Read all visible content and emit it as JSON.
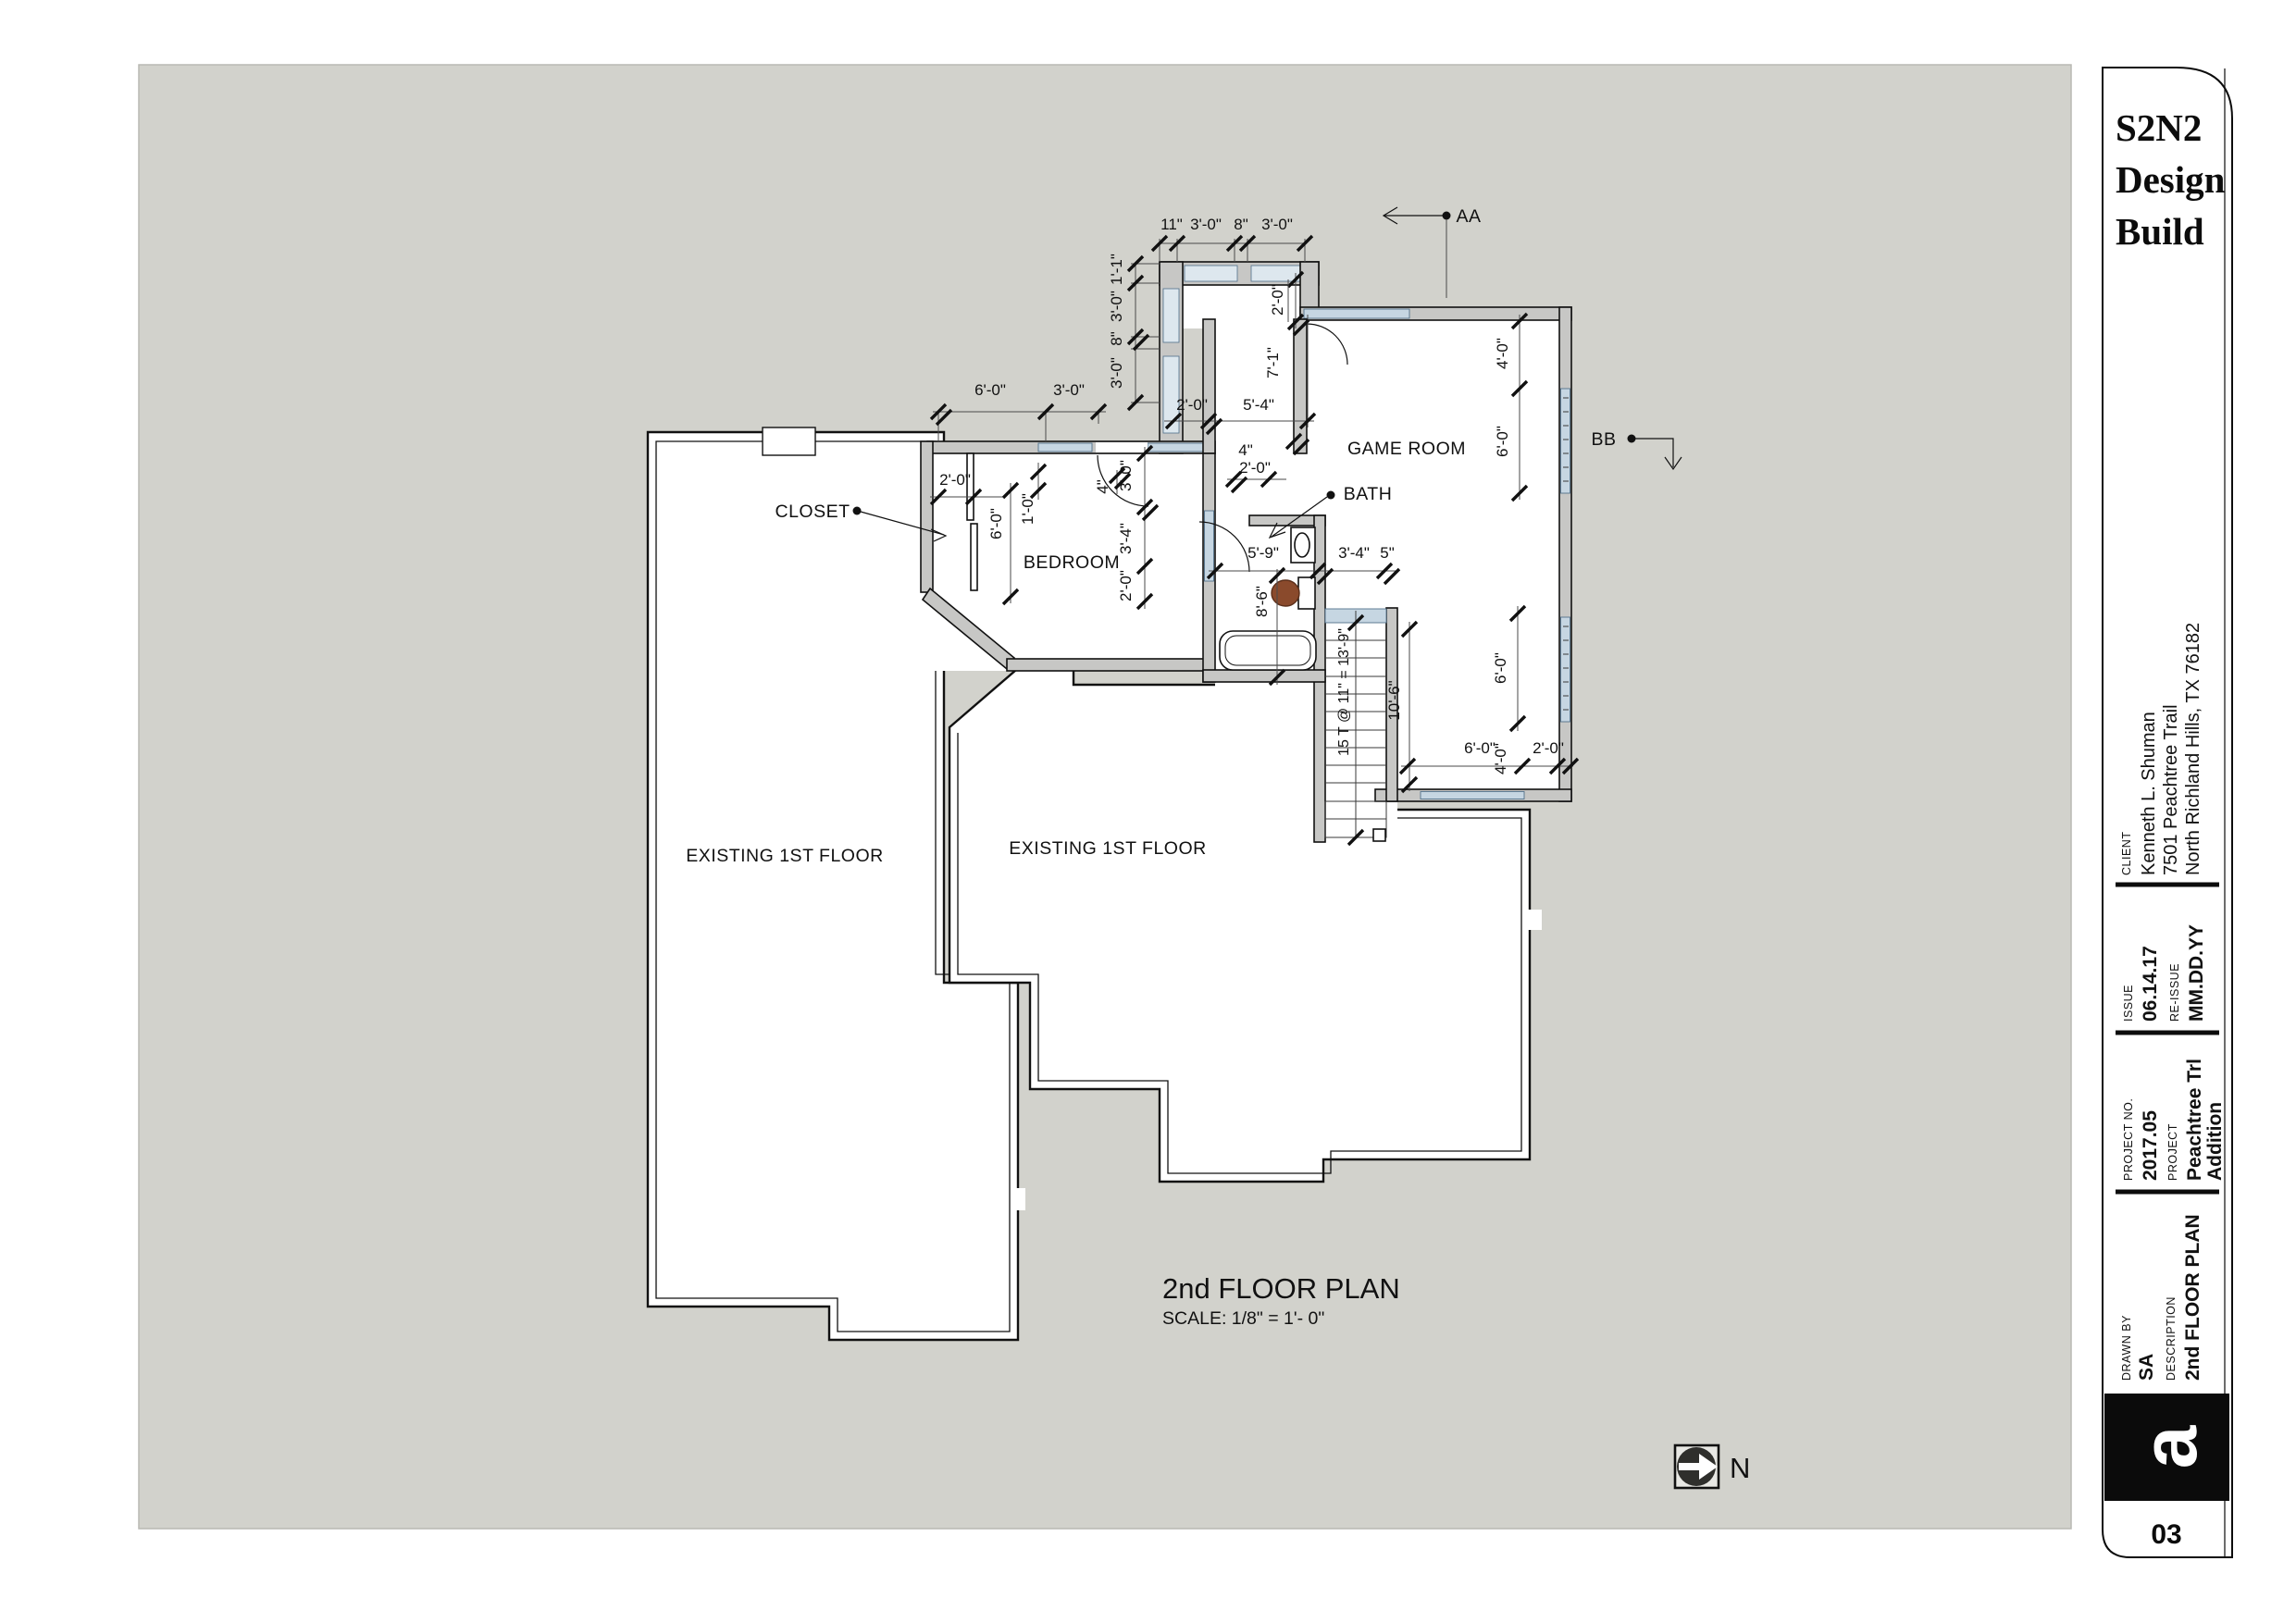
{
  "page": {
    "title": "2nd FLOOR PLAN",
    "scale": "SCALE: 1/8\" = 1'- 0\"",
    "north_label": "N"
  },
  "rooms": {
    "game_room": "GAME ROOM",
    "bath": "BATH",
    "closet": "CLOSET",
    "bedroom": "BEDROOM",
    "existing_left": "EXISTING 1ST FLOOR",
    "existing_center": "EXISTING 1ST FLOOR"
  },
  "sections": {
    "aa": "AA",
    "bb": "BB"
  },
  "dims": {
    "top_chain": [
      "11\"",
      "3'-0\"",
      "8\"",
      "3'-0\""
    ],
    "left_chain": [
      "1'-1\"",
      "3'-0\"",
      "8\"",
      "3'-0\""
    ],
    "bay_depth": "2'-0\"",
    "bay_height": "7'-1\"",
    "entry_left": "2'-0\"",
    "entry_opening": "5'-4\"",
    "wall_4a": "4\"",
    "hall_2_0": "2'-0\"",
    "bed_top": [
      "6'-0\"",
      "3'-0\""
    ],
    "closet_w": "2'-0\"",
    "closet_d": "6'-0\"",
    "closet_1_0": "1'-0\"",
    "bed_4": "4\"",
    "bed_chain": [
      "3'-0\"",
      "3'-4\"",
      "2'-0\""
    ],
    "bath_w": "5'-9\"",
    "stair_w": "3'-4\"",
    "stair_5": "5\"",
    "bath_h": "8'-6\"",
    "stair_note": "15 T @ 11\" = 13'-9\"",
    "stair_run": "10'-6\"",
    "gr_east": [
      "4'-0\"",
      "6'-0\""
    ],
    "gr_seast": "6'-0\"",
    "gr_bottom": [
      "6'-0\"",
      "4'-0\"",
      "2'-0\""
    ]
  },
  "title_block": {
    "logo_lines": [
      "S2N2",
      "Design",
      "Build"
    ],
    "client_label": "CLIENT",
    "client_lines": [
      "Kenneth L. Shuman",
      "7501 Peachtree Trail",
      "North Richland Hills, TX 76182"
    ],
    "issue_label": "ISSUE",
    "issue": "06.14.17",
    "reissue_label": "RE-ISSUE",
    "reissue": "MM.DD.YY",
    "project_no_label": "PROJECT NO.",
    "project_no": "2017.05",
    "project_label": "PROJECT",
    "project_lines": [
      "Peachtree Trl",
      "Addition"
    ],
    "drawn_by_label": "DRAWN BY",
    "drawn_by": "SA",
    "description_label": "DESCRIPTION",
    "description": "2nd FLOOR PLAN",
    "logo_mark": "a",
    "sheet_no": "03"
  },
  "colors": {
    "paper": "#d2d2cc",
    "wall_fill": "#c7c7c5",
    "window_blue": "#c6d6e2",
    "toilet_brown": "#8a4a2c",
    "ink": "#111111"
  }
}
